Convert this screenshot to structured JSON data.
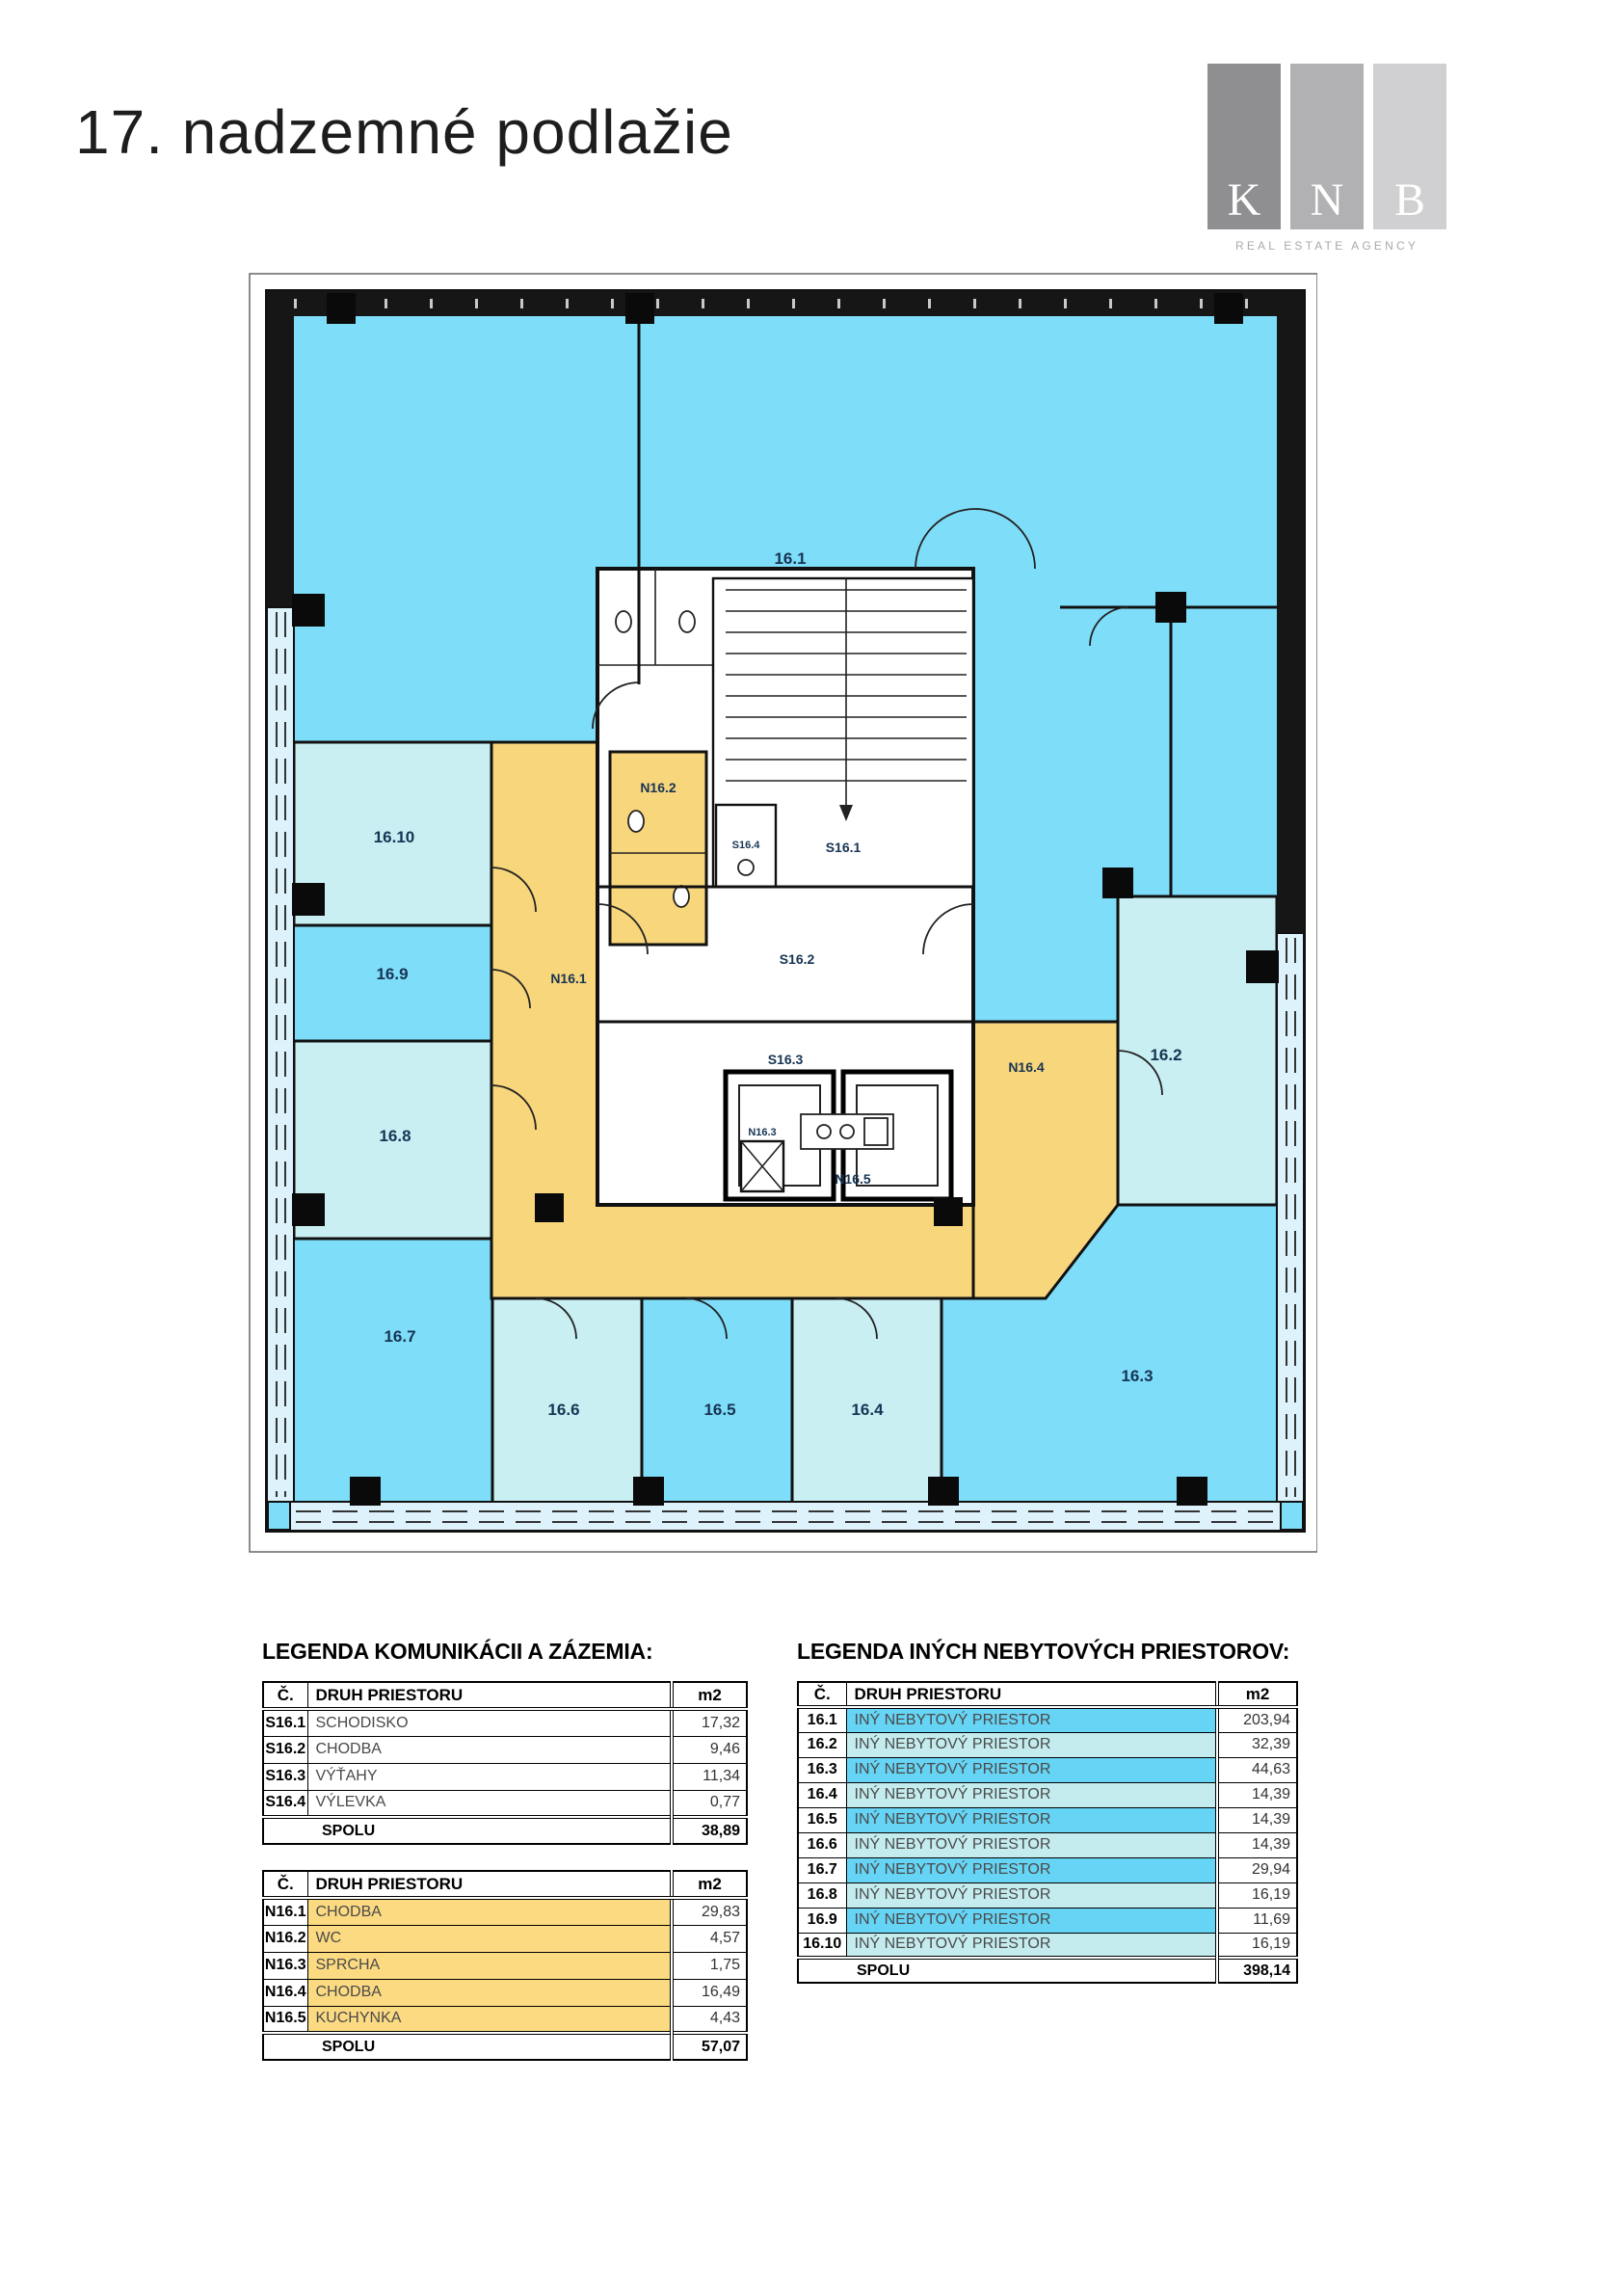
{
  "page": {
    "title": "17. nadzemné podlažie"
  },
  "logo": {
    "letters": [
      "K",
      "N",
      "B"
    ],
    "tagline": "REAL ESTATE AGENCY"
  },
  "colors": {
    "plan_bright": "#7eddf8",
    "plan_pale": "#c9eff2",
    "plan_yellow": "#f8d67c",
    "accent_bright": "#66d4f4",
    "accent_pale": "#c4ecee",
    "accent_yellow": "#fbda81",
    "logo_grey_1": "#8f8f91",
    "logo_grey_2": "#b1b1b3",
    "logo_grey_3": "#d0d0d2"
  },
  "plan": {
    "labels": {
      "r16_1": "16.1",
      "r16_2": "16.2",
      "r16_3": "16.3",
      "r16_4": "16.4",
      "r16_5": "16.5",
      "r16_6": "16.6",
      "r16_7": "16.7",
      "r16_8": "16.8",
      "r16_9": "16.9",
      "r16_10": "16.10",
      "s16_1": "S16.1",
      "s16_2": "S16.2",
      "s16_3": "S16.3",
      "s16_4": "S16.4",
      "n16_1": "N16.1",
      "n16_2": "N16.2",
      "n16_3": "N16.3",
      "n16_4": "N16.4",
      "n16_5": "N16.5"
    }
  },
  "headers": {
    "num": "Č.",
    "type": "DRUH PRIESTORU",
    "area": "m2"
  },
  "legend_left": {
    "title": "LEGENDA KOMUNIKÁCII A ZÁZEMIA:",
    "table1": {
      "rows": [
        {
          "num": "S16.1",
          "type": "SCHODISKO",
          "area": "17,32"
        },
        {
          "num": "S16.2",
          "type": "CHODBA",
          "area": "9,46"
        },
        {
          "num": "S16.3",
          "type": "VÝŤAHY",
          "area": "11,34"
        },
        {
          "num": "S16.4",
          "type": "VÝLEVKA",
          "area": "0,77"
        }
      ],
      "total_label": "SPOLU",
      "total": "38,89"
    },
    "table2": {
      "rows": [
        {
          "num": "N16.1",
          "type": "CHODBA",
          "area": "29,83"
        },
        {
          "num": "N16.2",
          "type": "WC",
          "area": "4,57"
        },
        {
          "num": "N16.3",
          "type": "SPRCHA",
          "area": "1,75"
        },
        {
          "num": "N16.4",
          "type": "CHODBA",
          "area": "16,49"
        },
        {
          "num": "N16.5",
          "type": "KUCHYNKA",
          "area": "4,43"
        }
      ],
      "total_label": "SPOLU",
      "total": "57,07"
    }
  },
  "legend_right": {
    "title": "LEGENDA INÝCH NEBYTOVÝCH PRIESTOROV:",
    "rows": [
      {
        "num": "16.1",
        "type": "INÝ NEBYTOVÝ PRIESTOR",
        "area": "203,94"
      },
      {
        "num": "16.2",
        "type": "INÝ NEBYTOVÝ PRIESTOR",
        "area": "32,39"
      },
      {
        "num": "16.3",
        "type": "INÝ NEBYTOVÝ PRIESTOR",
        "area": "44,63"
      },
      {
        "num": "16.4",
        "type": "INÝ NEBYTOVÝ PRIESTOR",
        "area": "14,39"
      },
      {
        "num": "16.5",
        "type": "INÝ NEBYTOVÝ PRIESTOR",
        "area": "14,39"
      },
      {
        "num": "16.6",
        "type": "INÝ NEBYTOVÝ PRIESTOR",
        "area": "14,39"
      },
      {
        "num": "16.7",
        "type": "INÝ NEBYTOVÝ PRIESTOR",
        "area": "29,94"
      },
      {
        "num": "16.8",
        "type": "INÝ NEBYTOVÝ PRIESTOR",
        "area": "16,19"
      },
      {
        "num": "16.9",
        "type": "INÝ NEBYTOVÝ PRIESTOR",
        "area": "11,69"
      },
      {
        "num": "16.10",
        "type": "INÝ NEBYTOVÝ PRIESTOR",
        "area": "16,19"
      }
    ],
    "total_label": "SPOLU",
    "total": "398,14"
  }
}
